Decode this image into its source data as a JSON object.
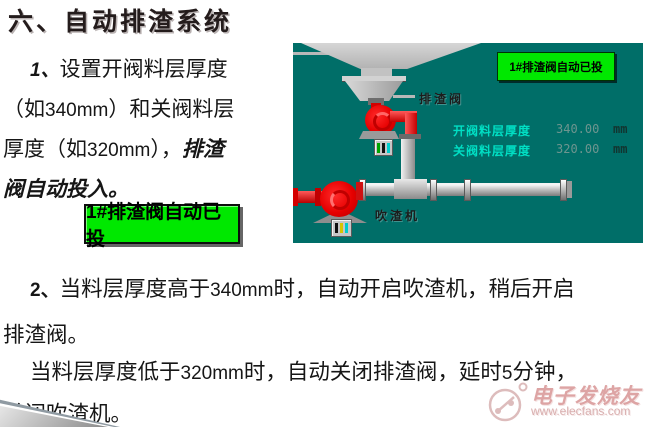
{
  "title": "六、自动排渣系统",
  "para1": {
    "line1": {
      "num": "1、",
      "text": "设置开阀料层厚度"
    },
    "line2": {
      "a": "（如",
      "val": "340mm",
      "b": "）和关阀料层"
    },
    "line3": {
      "a": "厚度（如",
      "val": "320mm",
      "b": "），",
      "emph": "排渣"
    },
    "line4": {
      "emph": "阀自动投入。"
    }
  },
  "auto_button": {
    "label": "1#排渣阀自动已投",
    "bg_color": "#00E800"
  },
  "hmi": {
    "bg_color": "#006E68",
    "button_label": "1#排渣阀自动已投",
    "valve_label": "排渣阀",
    "blower_label": "吹渣机",
    "readouts": [
      {
        "label": "开阀料层厚度",
        "value": "340.00",
        "unit": "mm"
      },
      {
        "label": "关阀料层厚度",
        "value": "320.00",
        "unit": "mm"
      }
    ],
    "colors": {
      "label_text": "#00DFC4",
      "equipment_red": "#E60000",
      "pipe_gray": "#BFBFBF"
    }
  },
  "para2": {
    "line1": {
      "num": "2、",
      "a": "当料层厚度高于",
      "val": "340mm",
      "b": "时，自动开启吹渣机，稍后开启"
    },
    "line2": {
      "a": "排渣阀。"
    }
  },
  "para3": {
    "line1": {
      "a": "当料层厚度低于",
      "val": "320mm",
      "b": "时，自动关闭排渣阀，延时",
      "val2": "5",
      "c": "分钟，"
    },
    "line2": {
      "a": "关闭吹渣机。"
    }
  },
  "watermark": {
    "brand": "电子发烧友",
    "url": "www.elecfans.com"
  }
}
